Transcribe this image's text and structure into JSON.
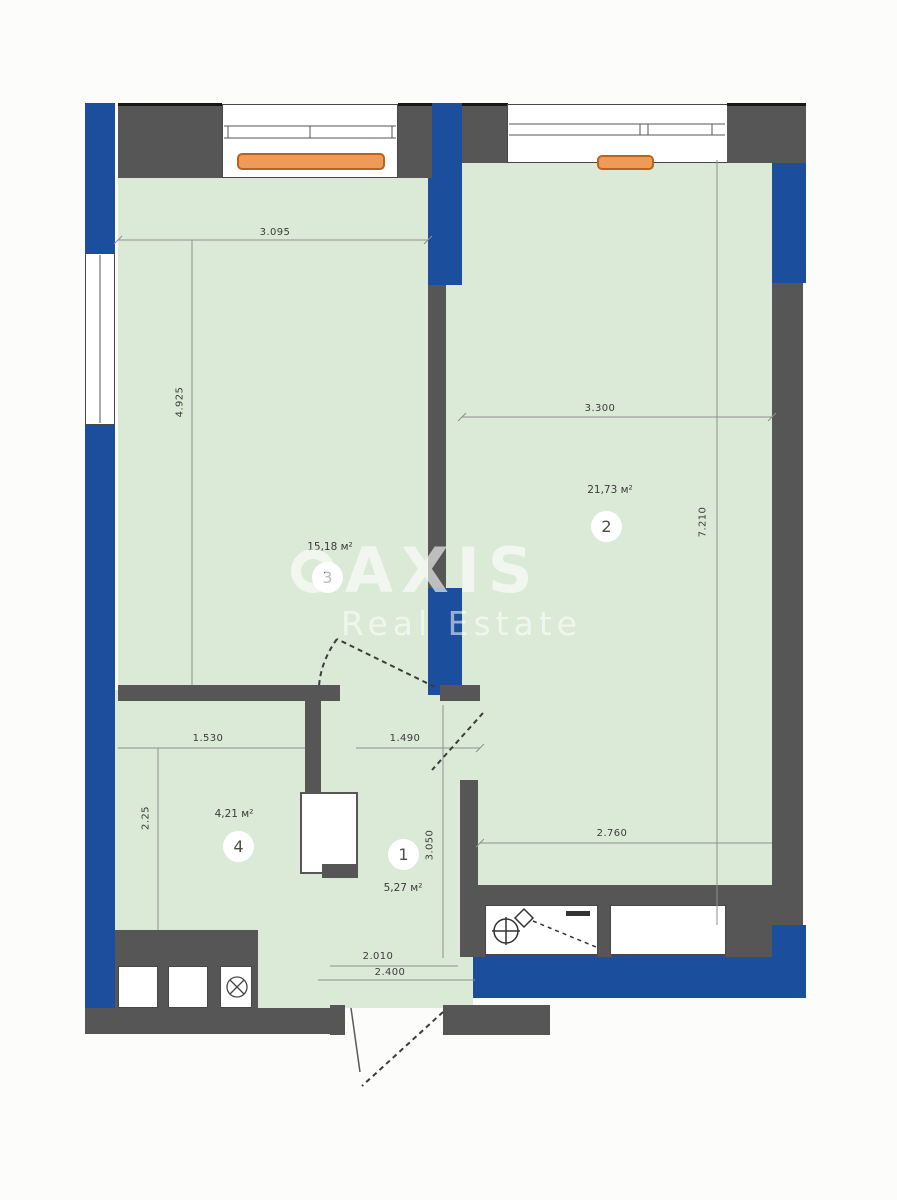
{
  "watermark": {
    "brand": "AXIS",
    "tagline": "Real Estate"
  },
  "rooms": [
    {
      "number": "1",
      "area": "5,27 м²"
    },
    {
      "number": "2",
      "area": "21,73 м²"
    },
    {
      "number": "3",
      "area": "15,18 м²"
    },
    {
      "number": "4",
      "area": "4,21 м²"
    }
  ],
  "dimensions": {
    "room3_width": "3.095",
    "room3_height": "4.925",
    "room2_width": "3.300",
    "room2_height": "7.210",
    "room2_lower_width": "2.760",
    "room4_width": "1.530",
    "hall_width": "1.490",
    "room4_height": "2.25",
    "hall_height": "3.050",
    "entrance_width": "2.010",
    "entrance_outer_width": "2.400"
  },
  "colors": {
    "wall_blue": "#1b4f9d",
    "wall_gray": "#565656",
    "floor_green": "#dbead6",
    "radiator_orange": "#ef9b57"
  }
}
